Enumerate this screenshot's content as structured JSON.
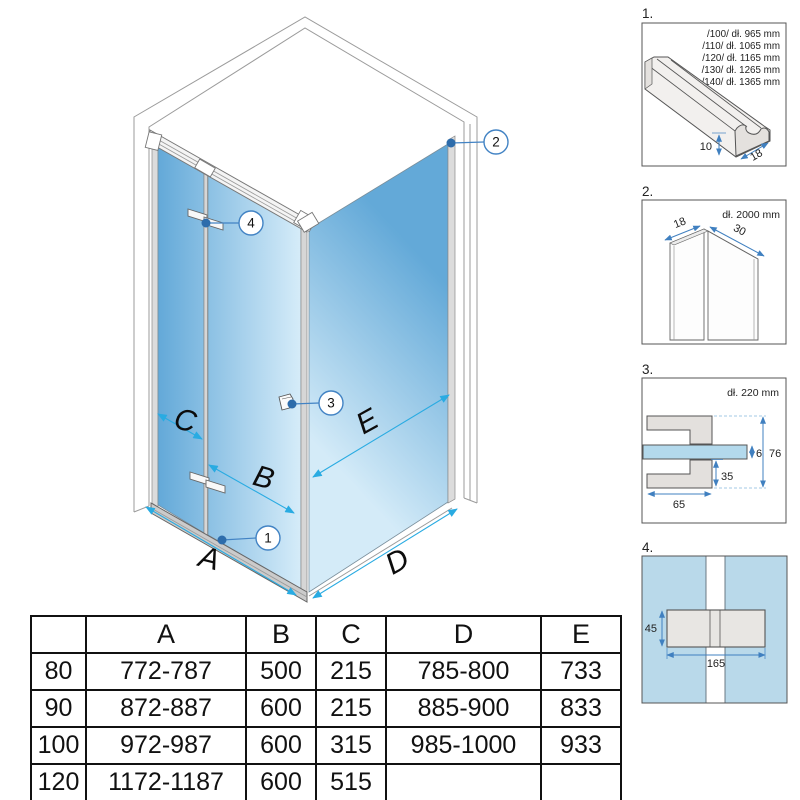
{
  "diagram": {
    "letters": {
      "A": "A",
      "B": "B",
      "C": "C",
      "D": "D",
      "E": "E"
    },
    "callouts": [
      "1",
      "2",
      "3",
      "4"
    ]
  },
  "details": {
    "panel1": {
      "label": "1.",
      "lines": [
        "/100/ dł. 965 mm",
        "/110/ dł. 1065 mm",
        "/120/ dł. 1165 mm",
        "/130/ dł. 1265 mm",
        "/140/ dł. 1365 mm"
      ],
      "dim_height": "10",
      "dim_width": "18"
    },
    "panel2": {
      "label": "2.",
      "length": "dł. 2000 mm",
      "dim_depth": "18",
      "dim_width": "30"
    },
    "panel3": {
      "label": "3.",
      "length": "dł. 220 mm",
      "dim_glass": "6",
      "dim_height": "76",
      "dim_offset": "35",
      "dim_width": "65"
    },
    "panel4": {
      "label": "4.",
      "dim_height": "45",
      "dim_width": "165"
    }
  },
  "table": {
    "headers": [
      "",
      "A",
      "B",
      "C",
      "D",
      "E"
    ],
    "rows": [
      [
        "80",
        "772-787",
        "500",
        "215",
        "785-800",
        "733"
      ],
      [
        "90",
        "872-887",
        "600",
        "215",
        "885-900",
        "833"
      ],
      [
        "100",
        "972-987",
        "600",
        "315",
        "985-1000",
        "933"
      ],
      [
        "120",
        "1172-1187",
        "600",
        "515",
        "",
        ""
      ]
    ]
  },
  "colors": {
    "glass_dark": "#5ea6d7",
    "glass_light": "#d9eefa",
    "dimension_blue": "#29abe2",
    "callout_blue": "#4283c4",
    "dot_blue": "#2d6cab",
    "panel_arrow_blue": "#4080c0",
    "profile_gray": "#d6d6d6"
  }
}
